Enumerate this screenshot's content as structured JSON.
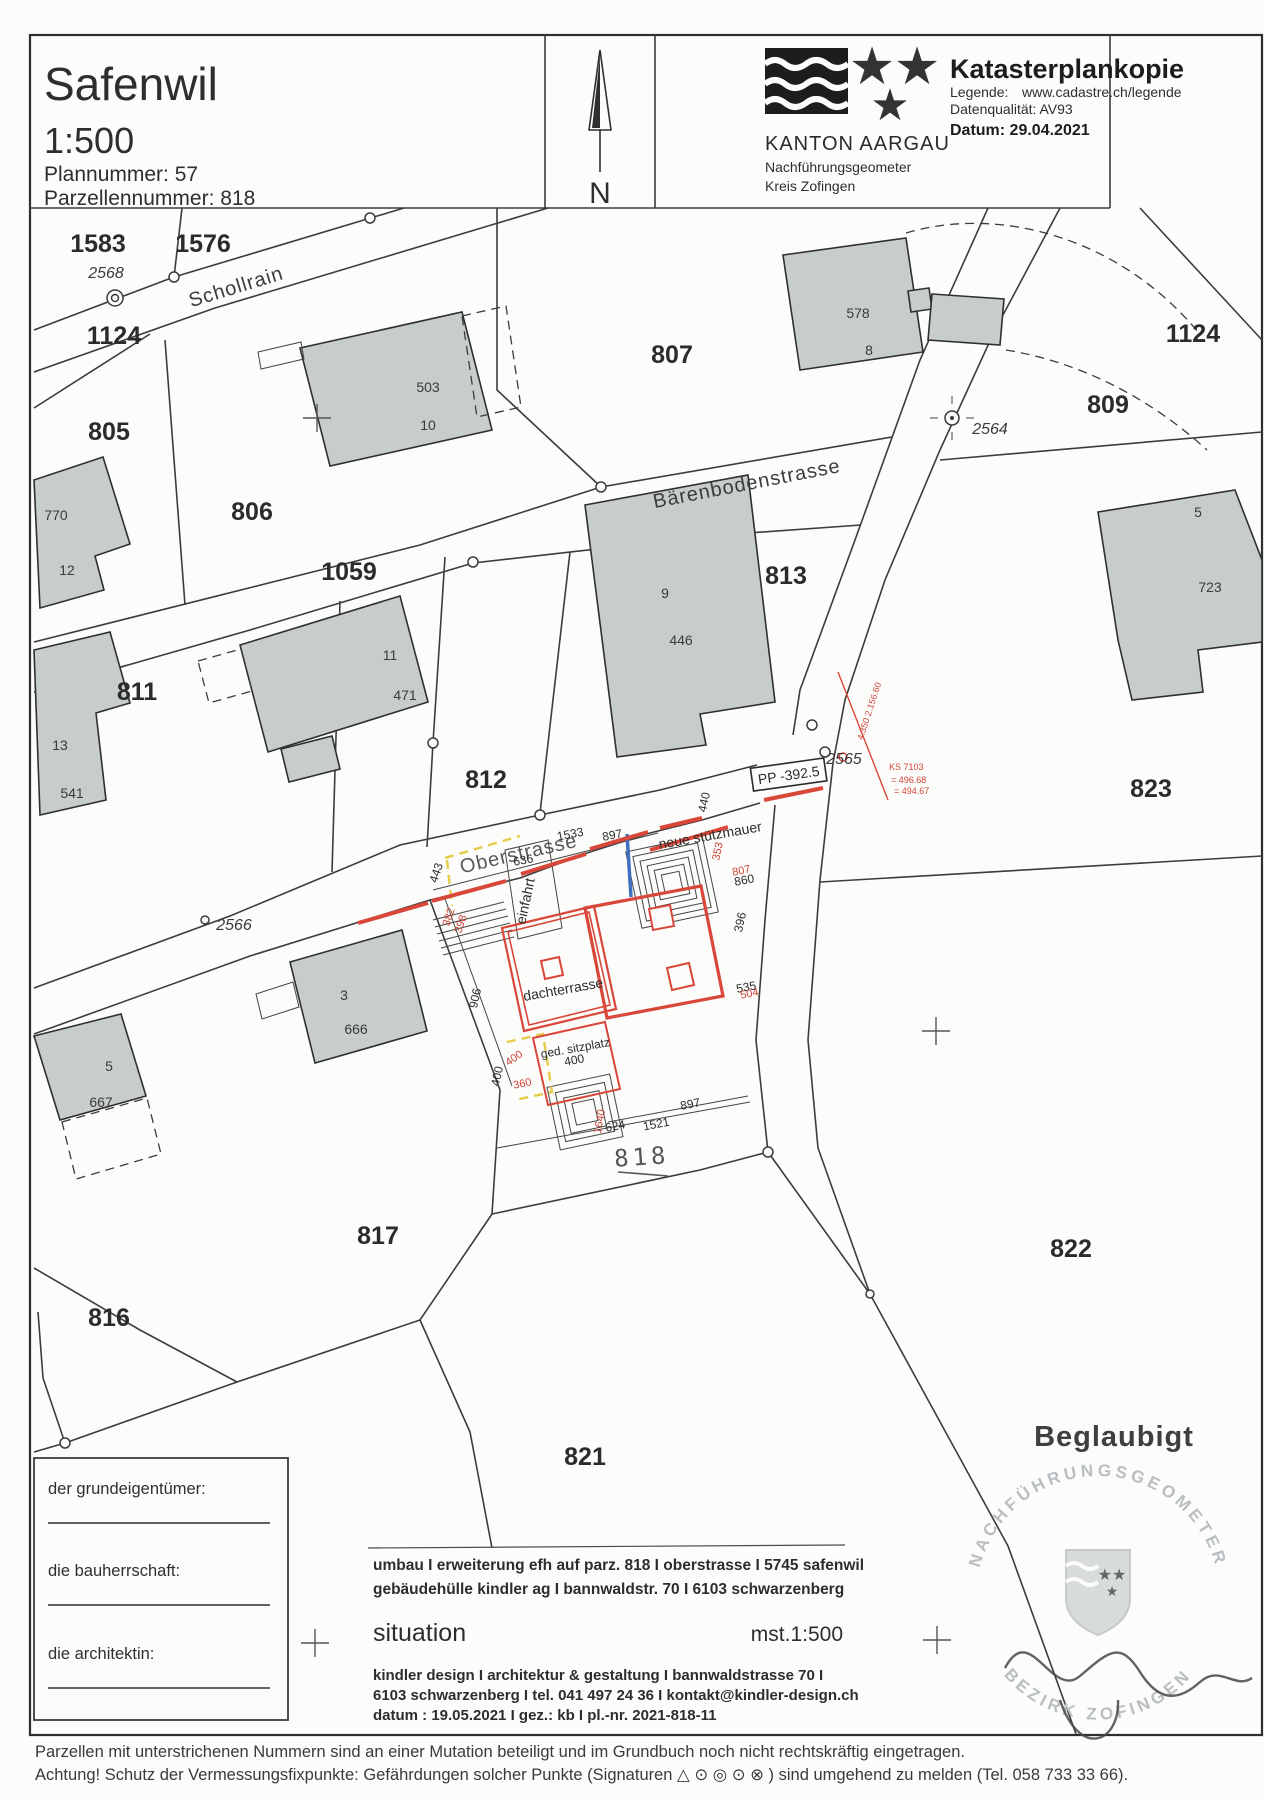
{
  "header": {
    "title": "Safenwil",
    "scale": "1:500",
    "plan_number": "Plannummer: 57",
    "parcel_number": "Parzellennummer: 818",
    "north": "N",
    "canton": "KANTON AARGAU",
    "office1": "Nachführungsgeometer",
    "office2": "Kreis Zofingen",
    "doc_title": "Katasterplankopie",
    "legend_label": "Legende:",
    "legend_url": "www.cadastre.ch/legende",
    "data_quality": "Datenqualität: AV93",
    "date": "Datum: 29.04.2021"
  },
  "map": {
    "streets": {
      "schollrain": "Schollrain",
      "baerenboden": "Bärenbodenstrasse",
      "oberstrasse": "Oberstrasse"
    },
    "parcels": {
      "p1583": "1583",
      "p1576": "1576",
      "p1124a": "1124",
      "p805": "805",
      "p806": "806",
      "p807": "807",
      "p809": "809",
      "p1124b": "1124",
      "p1059": "1059",
      "p811": "811",
      "p812": "812",
      "p813": "813",
      "p823": "823",
      "p816": "816",
      "p817": "817",
      "p818": "818",
      "p821": "821",
      "p822": "822",
      "p1533": "1533"
    },
    "points": {
      "n2568": "2568",
      "n2564": "2564",
      "n2565": "2565",
      "n2566": "2566"
    },
    "buildings": {
      "b503": "503",
      "b10": "10",
      "b770": "770",
      "b12": "12",
      "b578": "578",
      "b8": "8",
      "b9": "9",
      "b446": "446",
      "b5a": "5",
      "b723": "723",
      "b11": "11",
      "b471": "471",
      "b13": "13",
      "b541": "541",
      "b3": "3",
      "b666": "666",
      "b5b": "5",
      "b667": "667"
    },
    "dims": {
      "d443": "443",
      "d636": "636",
      "d897a": "897",
      "d906": "906",
      "d400v": "400",
      "d400b": "400",
      "d624": "624",
      "d1521": "1521",
      "d897b": "897",
      "d535": "535",
      "d860": "860",
      "d440": "440",
      "d396": "396"
    },
    "dims_red": {
      "r382": "382",
      "r398": "398",
      "r400": "400",
      "r360": "360",
      "r1640": "1640",
      "r504": "504",
      "r807": "807",
      "r353": "353"
    },
    "annotations": {
      "einfahrt": "einfahrt",
      "dachterrasse": "dachterrasse",
      "sitzplatz": "ged. sitzplatz",
      "stuetzmauer": "neue stützmauer",
      "pp": "PP -392.5",
      "ks": "KS 7103",
      "elev1": "= 496.68",
      "elev2": "= 494.67",
      "survey": "4.350  2.156.60"
    },
    "certified": "Beglaubigt",
    "stamp_top": "NACHFÜHRUNGSGEOMETER",
    "stamp_bottom": "BEZIRK ZOFINGEN"
  },
  "form": {
    "owner": "der grundeigentümer:",
    "client": "die bauherrschaft:",
    "architect": "die architektin:"
  },
  "titleblock": {
    "project1": "umbau  I  erweiterung efh auf parz. 818  I  oberstrasse   I 5745 safenwil",
    "project2": "gebäudehülle kindler ag    I    bannwaldstr. 70    I    6103 schwarzenberg",
    "drawing": "situation",
    "scale": "mst.1:500",
    "firm1": "kindler design    I    architektur & gestaltung    I    bannwaldstrasse 70  I",
    "firm2": "6103 schwarzenberg  I tel.  041 497 24 36  I kontakt@kindler-design.ch",
    "firm3": "datum : 19.05.2021    I    gez.: kb    I    pl.-nr. 2021-818-11"
  },
  "footer": {
    "line1": "Parzellen mit unterstrichenen Nummern sind an einer Mutation beteiligt und im Grundbuch noch nicht rechtskräftig eingetragen.",
    "line2": "Achtung! Schutz der Vermessungsfixpunkte: Gefährdungen solcher Punkte (Signaturen △ ⊙ ◎ ⊙ ⊗ ) sind umgehend zu melden (Tel. 058 733 33 66)."
  },
  "colors": {
    "red": "#d9473a",
    "yellow": "#e6cf4e",
    "blue": "#3f6fbe",
    "building": "#c7cdcb",
    "stamp": "#b9bec2"
  }
}
